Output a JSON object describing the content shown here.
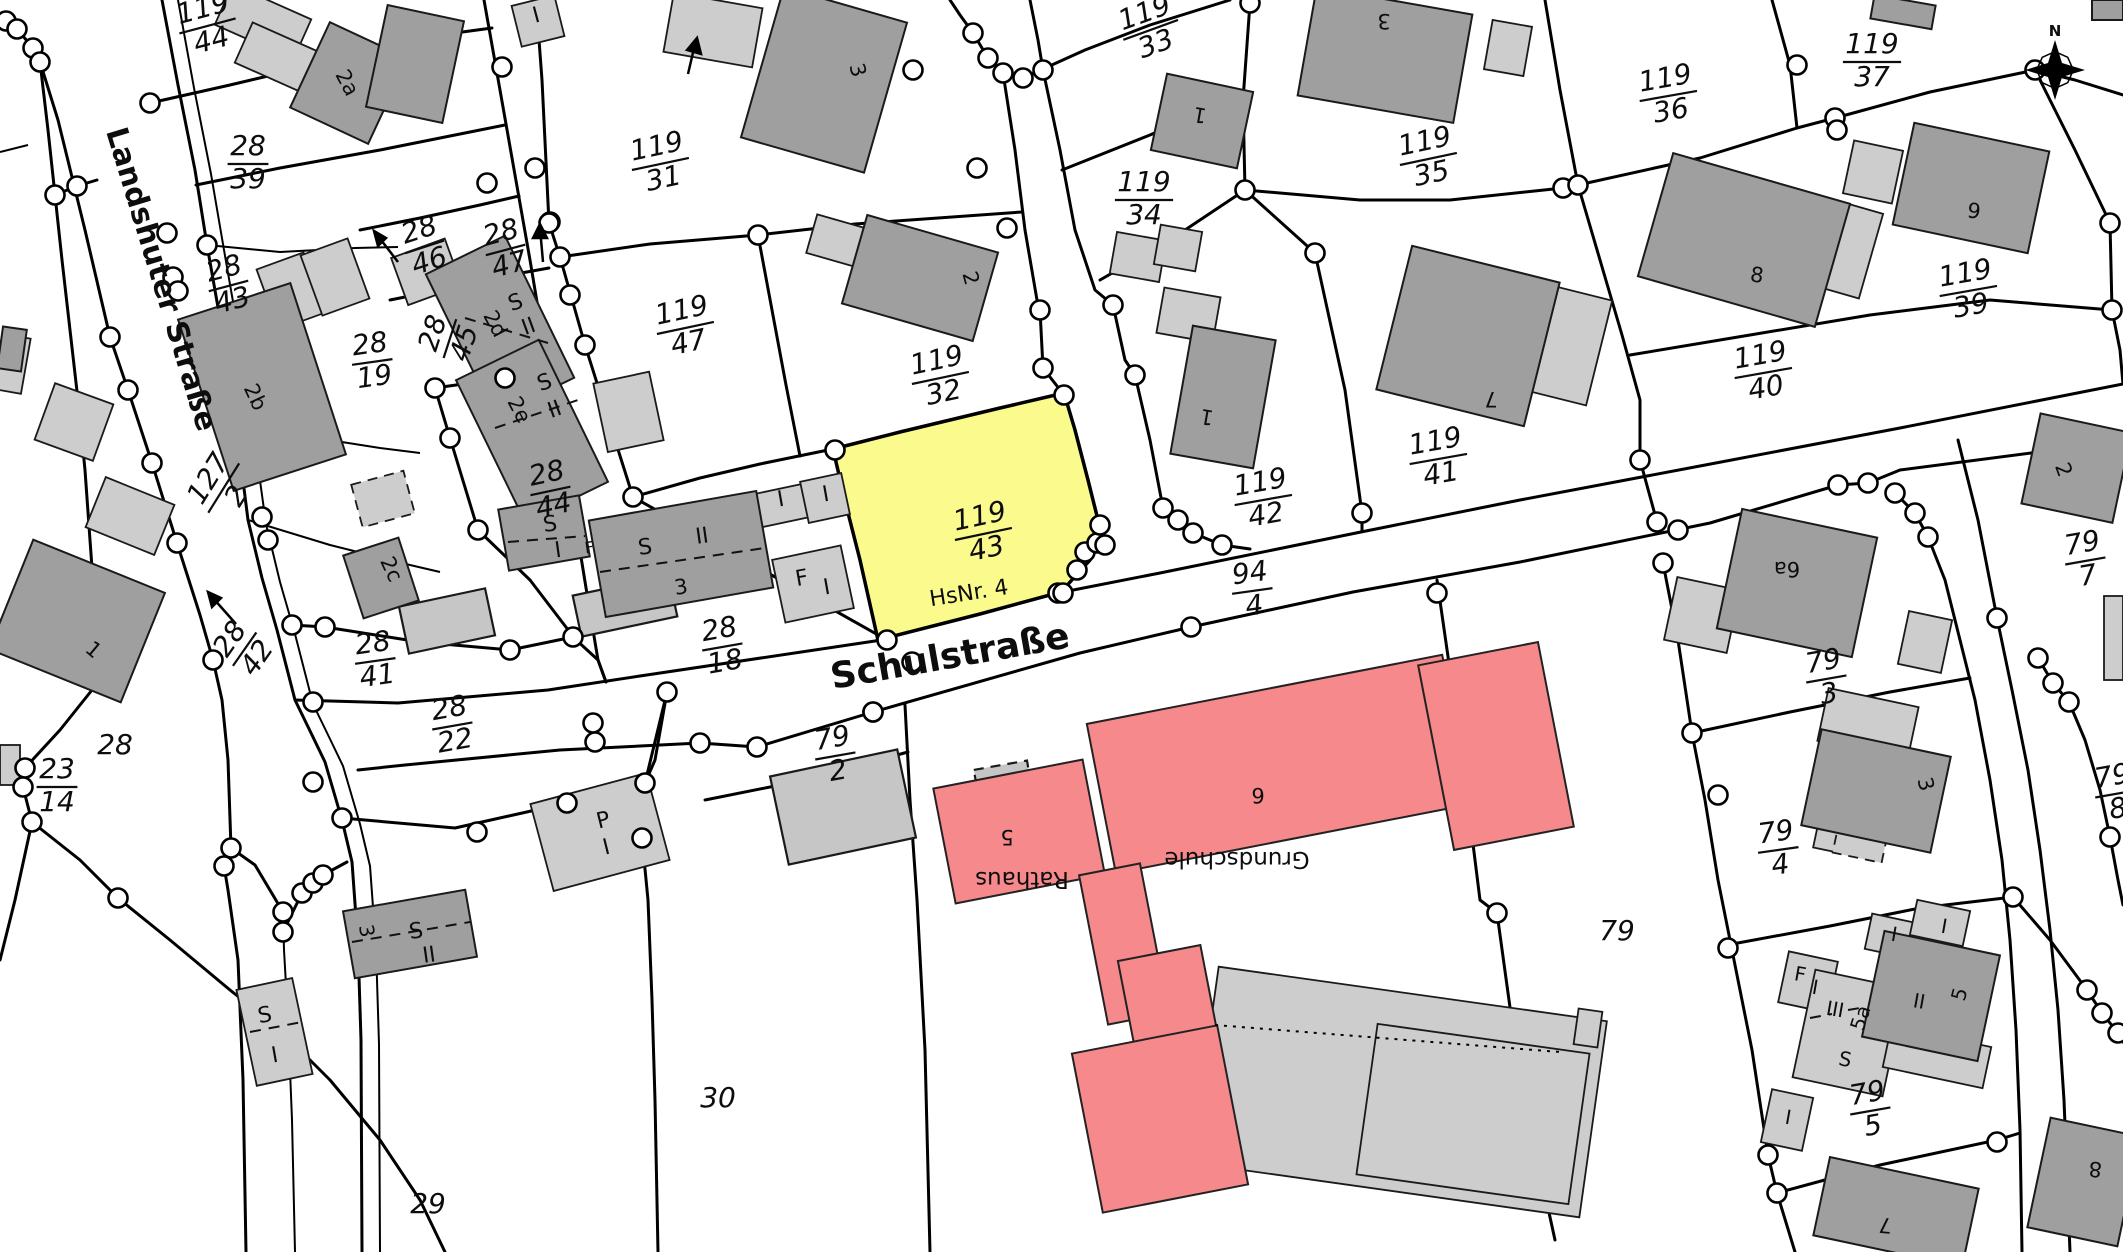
{
  "map": {
    "highlighted_parcel": {
      "number": "119/43",
      "house_no_label": "HsNr. 4"
    },
    "streets": [
      "Landshuter Straße",
      "Schulstraße"
    ],
    "public_buildings": [
      "Rathaus",
      "Grundschule"
    ],
    "north_indicator": "N"
  },
  "colors": {
    "background": "#ffffff",
    "boundary_line": "#000000",
    "building_dark": "#9f9f9f",
    "building_light": "#cdcdcd",
    "building_mid": "#c6c6c6",
    "building_public_red": "#f5898b",
    "parcel_highlight_yellow": "#fbfa8d",
    "survey_point_fill": "#ffffff"
  },
  "parcel_labels": [
    {
      "num": "119",
      "den": "44",
      "x": 207,
      "y": 24,
      "r": -15
    },
    {
      "num": "28",
      "den": "39",
      "x": 248,
      "y": 162,
      "r": 0
    },
    {
      "num": "119",
      "den": "31",
      "x": 660,
      "y": 162,
      "r": -12
    },
    {
      "num": "119",
      "den": "33",
      "x": 1150,
      "y": 28,
      "r": -20
    },
    {
      "num": "119",
      "den": "34",
      "x": 1144,
      "y": 198,
      "r": 0
    },
    {
      "num": "119",
      "den": "35",
      "x": 1428,
      "y": 157,
      "r": -12
    },
    {
      "num": "119",
      "den": "36",
      "x": 1668,
      "y": 94,
      "r": -10
    },
    {
      "num": "119",
      "den": "37",
      "x": 1872,
      "y": 60,
      "r": 0
    },
    {
      "num": "119",
      "den": "39",
      "x": 1968,
      "y": 289,
      "r": -10
    },
    {
      "num": "119",
      "den": "40",
      "x": 1763,
      "y": 371,
      "r": -10
    },
    {
      "num": "119",
      "den": "41",
      "x": 1438,
      "y": 457,
      "r": -10
    },
    {
      "num": "119",
      "den": "42",
      "x": 1263,
      "y": 498,
      "r": -10
    },
    {
      "num": "119",
      "den": "43",
      "x": 983,
      "y": 532,
      "r": -12
    },
    {
      "num": "119",
      "den": "47",
      "x": 685,
      "y": 326,
      "r": -12
    },
    {
      "num": "119",
      "den": "32",
      "x": 940,
      "y": 376,
      "r": -12
    },
    {
      "num": "28",
      "den": "43",
      "x": 228,
      "y": 284,
      "r": -15
    },
    {
      "num": "28",
      "den": "46",
      "x": 424,
      "y": 245,
      "r": -18
    },
    {
      "num": "28",
      "den": "47",
      "x": 505,
      "y": 248,
      "r": -15
    },
    {
      "num": "28",
      "den": "19",
      "x": 372,
      "y": 360,
      "r": -8
    },
    {
      "num": "28",
      "den": "45",
      "x": 448,
      "y": 338,
      "r": -72
    },
    {
      "num": "28",
      "den": "44",
      "x": 550,
      "y": 489,
      "r": -12
    },
    {
      "num": "28",
      "den": "18",
      "x": 722,
      "y": 645,
      "r": -10
    },
    {
      "num": "28",
      "den": "41",
      "x": 375,
      "y": 659,
      "r": -8
    },
    {
      "num": "28",
      "den": "22",
      "x": 452,
      "y": 724,
      "r": -10
    },
    {
      "num": "28",
      "den": "42",
      "x": 243,
      "y": 648,
      "r": -55
    },
    {
      "num": "127",
      "den": "2",
      "x": 222,
      "y": 487,
      "r": -58
    },
    {
      "num": "94",
      "den": "4",
      "x": 1252,
      "y": 589,
      "r": -8
    },
    {
      "num": "79",
      "den": "2",
      "x": 835,
      "y": 754,
      "r": -10
    },
    {
      "num": "79",
      "den": "3",
      "x": 1826,
      "y": 677,
      "r": -10
    },
    {
      "num": "79",
      "den": "4",
      "x": 1778,
      "y": 848,
      "r": -8
    },
    {
      "num": "79",
      "den": "5",
      "x": 1870,
      "y": 1109,
      "r": -10
    },
    {
      "num": "79",
      "den": "7",
      "x": 2085,
      "y": 559,
      "r": -10
    },
    {
      "num": "79",
      "den": "8",
      "x": 2115,
      "y": 792,
      "r": -10
    },
    {
      "num": "23",
      "den": "14",
      "x": 57,
      "y": 785,
      "r": 0
    }
  ],
  "text_labels": [
    {
      "t": "Landshuter Straße",
      "x": 152,
      "y": 282,
      "r": 73,
      "s": 30,
      "b": 1,
      "name": "street-name-landshuter"
    },
    {
      "t": "Schulstraße",
      "x": 952,
      "y": 668,
      "r": -10,
      "s": 36,
      "b": 1,
      "name": "street-name-schulstrasse"
    },
    {
      "t": "HsNr. 4",
      "x": 970,
      "y": 600,
      "r": -9,
      "s": 22,
      "name": "house-number-label"
    },
    {
      "t": "Rathaus",
      "x": 1022,
      "y": 872,
      "r": 180,
      "s": 23,
      "name": "building-name-rathaus"
    },
    {
      "t": "5",
      "x": 1007,
      "y": 830,
      "r": 180,
      "s": 21
    },
    {
      "t": "Grundschule",
      "x": 1237,
      "y": 852,
      "r": 180,
      "s": 23,
      "name": "building-name-grundschule"
    },
    {
      "t": "6",
      "x": 1258,
      "y": 788,
      "r": 180,
      "s": 21
    },
    {
      "t": "N",
      "x": 2055,
      "y": 36,
      "r": 0,
      "s": 15,
      "b": 1,
      "name": "north-letter"
    },
    {
      "t": "28",
      "x": 115,
      "y": 754,
      "r": 0,
      "s": 28,
      "i": 1
    },
    {
      "t": "29",
      "x": 428,
      "y": 1213,
      "r": 0,
      "s": 28,
      "i": 1
    },
    {
      "t": "30",
      "x": 718,
      "y": 1107,
      "r": 0,
      "s": 28,
      "i": 1
    },
    {
      "t": "79",
      "x": 1617,
      "y": 940,
      "r": 0,
      "s": 28,
      "i": 1
    },
    {
      "t": "2a",
      "x": 341,
      "y": 86,
      "r": 62,
      "s": 21
    },
    {
      "t": "2b",
      "x": 249,
      "y": 400,
      "r": 65,
      "s": 21
    },
    {
      "t": "2c",
      "x": 385,
      "y": 572,
      "r": 65,
      "s": 21
    },
    {
      "t": "2d",
      "x": 489,
      "y": 327,
      "r": 62,
      "s": 21
    },
    {
      "t": "2e",
      "x": 513,
      "y": 413,
      "r": 62,
      "s": 21
    },
    {
      "t": "3",
      "x": 851,
      "y": 72,
      "r": 75,
      "s": 21
    },
    {
      "t": "2",
      "x": 964,
      "y": 280,
      "r": 75,
      "s": 21
    },
    {
      "t": "3",
      "x": 1384,
      "y": 14,
      "r": 180,
      "s": 21
    },
    {
      "t": "1",
      "x": 1201,
      "y": 108,
      "r": 190,
      "s": 21
    },
    {
      "t": "1",
      "x": 1208,
      "y": 410,
      "r": 190,
      "s": 21
    },
    {
      "t": "7",
      "x": 1491,
      "y": 392,
      "r": 180,
      "s": 21
    },
    {
      "t": "9",
      "x": 1973,
      "y": 218,
      "r": 8,
      "s": 21
    },
    {
      "t": "8",
      "x": 1756,
      "y": 282,
      "r": 8,
      "s": 21
    },
    {
      "t": "2",
      "x": 2057,
      "y": 472,
      "r": 70,
      "s": 21
    },
    {
      "t": "6a",
      "x": 1787,
      "y": 562,
      "r": 180,
      "s": 21
    },
    {
      "t": "3",
      "x": 1919,
      "y": 786,
      "r": 75,
      "s": 21
    },
    {
      "t": "1",
      "x": 89,
      "y": 655,
      "r": 40,
      "s": 21
    },
    {
      "t": "7",
      "x": 1886,
      "y": 1218,
      "r": 185,
      "s": 21
    },
    {
      "t": "8",
      "x": 2096,
      "y": 1162,
      "r": 185,
      "s": 21
    },
    {
      "t": "3",
      "x": 360,
      "y": 932,
      "r": 80,
      "s": 20
    },
    {
      "t": "5",
      "x": 1966,
      "y": 996,
      "r": -75,
      "s": 20
    },
    {
      "t": "5a",
      "x": 1867,
      "y": 1020,
      "r": -72,
      "s": 20
    },
    {
      "t": "S",
      "x": 551,
      "y": 531,
      "r": -8,
      "s": 22
    },
    {
      "t": "I",
      "x": 559,
      "y": 557,
      "r": -8,
      "s": 22
    },
    {
      "t": "F",
      "x": 590,
      "y": 553,
      "r": -8,
      "s": 16
    },
    {
      "t": "S",
      "x": 646,
      "y": 554,
      "r": -8,
      "s": 22
    },
    {
      "t": "II",
      "x": 703,
      "y": 543,
      "r": -8,
      "s": 22
    },
    {
      "t": "3",
      "x": 682,
      "y": 594,
      "r": -8,
      "s": 21
    },
    {
      "t": "I",
      "x": 782,
      "y": 506,
      "r": -10,
      "s": 22
    },
    {
      "t": "I",
      "x": 827,
      "y": 501,
      "r": -10,
      "s": 22
    },
    {
      "t": "F",
      "x": 803,
      "y": 585,
      "r": -10,
      "s": 22
    },
    {
      "t": "I",
      "x": 828,
      "y": 594,
      "r": -10,
      "s": 22
    },
    {
      "t": "P",
      "x": 605,
      "y": 827,
      "r": -14,
      "s": 22
    },
    {
      "t": "I",
      "x": 608,
      "y": 854,
      "r": -14,
      "s": 22
    },
    {
      "t": "S",
      "x": 417,
      "y": 938,
      "r": -8,
      "s": 22
    },
    {
      "t": "II",
      "x": 430,
      "y": 962,
      "r": -8,
      "s": 22
    },
    {
      "t": "S",
      "x": 266,
      "y": 1022,
      "r": -10,
      "s": 22
    },
    {
      "t": "I",
      "x": 276,
      "y": 1062,
      "r": -10,
      "s": 22
    },
    {
      "t": "I",
      "x": 538,
      "y": 22,
      "r": -15,
      "s": 22
    },
    {
      "t": "S",
      "x": 518,
      "y": 309,
      "r": -20,
      "s": 22
    },
    {
      "t": "II",
      "x": 531,
      "y": 333,
      "r": -20,
      "s": 22
    },
    {
      "t": "S",
      "x": 547,
      "y": 389,
      "r": -20,
      "s": 22
    },
    {
      "t": "II",
      "x": 557,
      "y": 416,
      "r": -20,
      "s": 22
    },
    {
      "t": "I",
      "x": 1893,
      "y": 941,
      "r": 10,
      "s": 20
    },
    {
      "t": "I",
      "x": 1943,
      "y": 933,
      "r": 10,
      "s": 20
    },
    {
      "t": "F",
      "x": 1799,
      "y": 981,
      "r": 10,
      "s": 20
    },
    {
      "t": "I",
      "x": 1814,
      "y": 994,
      "r": 10,
      "s": 20
    },
    {
      "t": "III",
      "x": 1834,
      "y": 1016,
      "r": 10,
      "s": 20
    },
    {
      "t": "S",
      "x": 1844,
      "y": 1066,
      "r": 10,
      "s": 20
    },
    {
      "t": "II",
      "x": 1918,
      "y": 1008,
      "r": 10,
      "s": 20
    },
    {
      "t": "I",
      "x": 1787,
      "y": 1124,
      "r": 10,
      "s": 20
    }
  ]
}
